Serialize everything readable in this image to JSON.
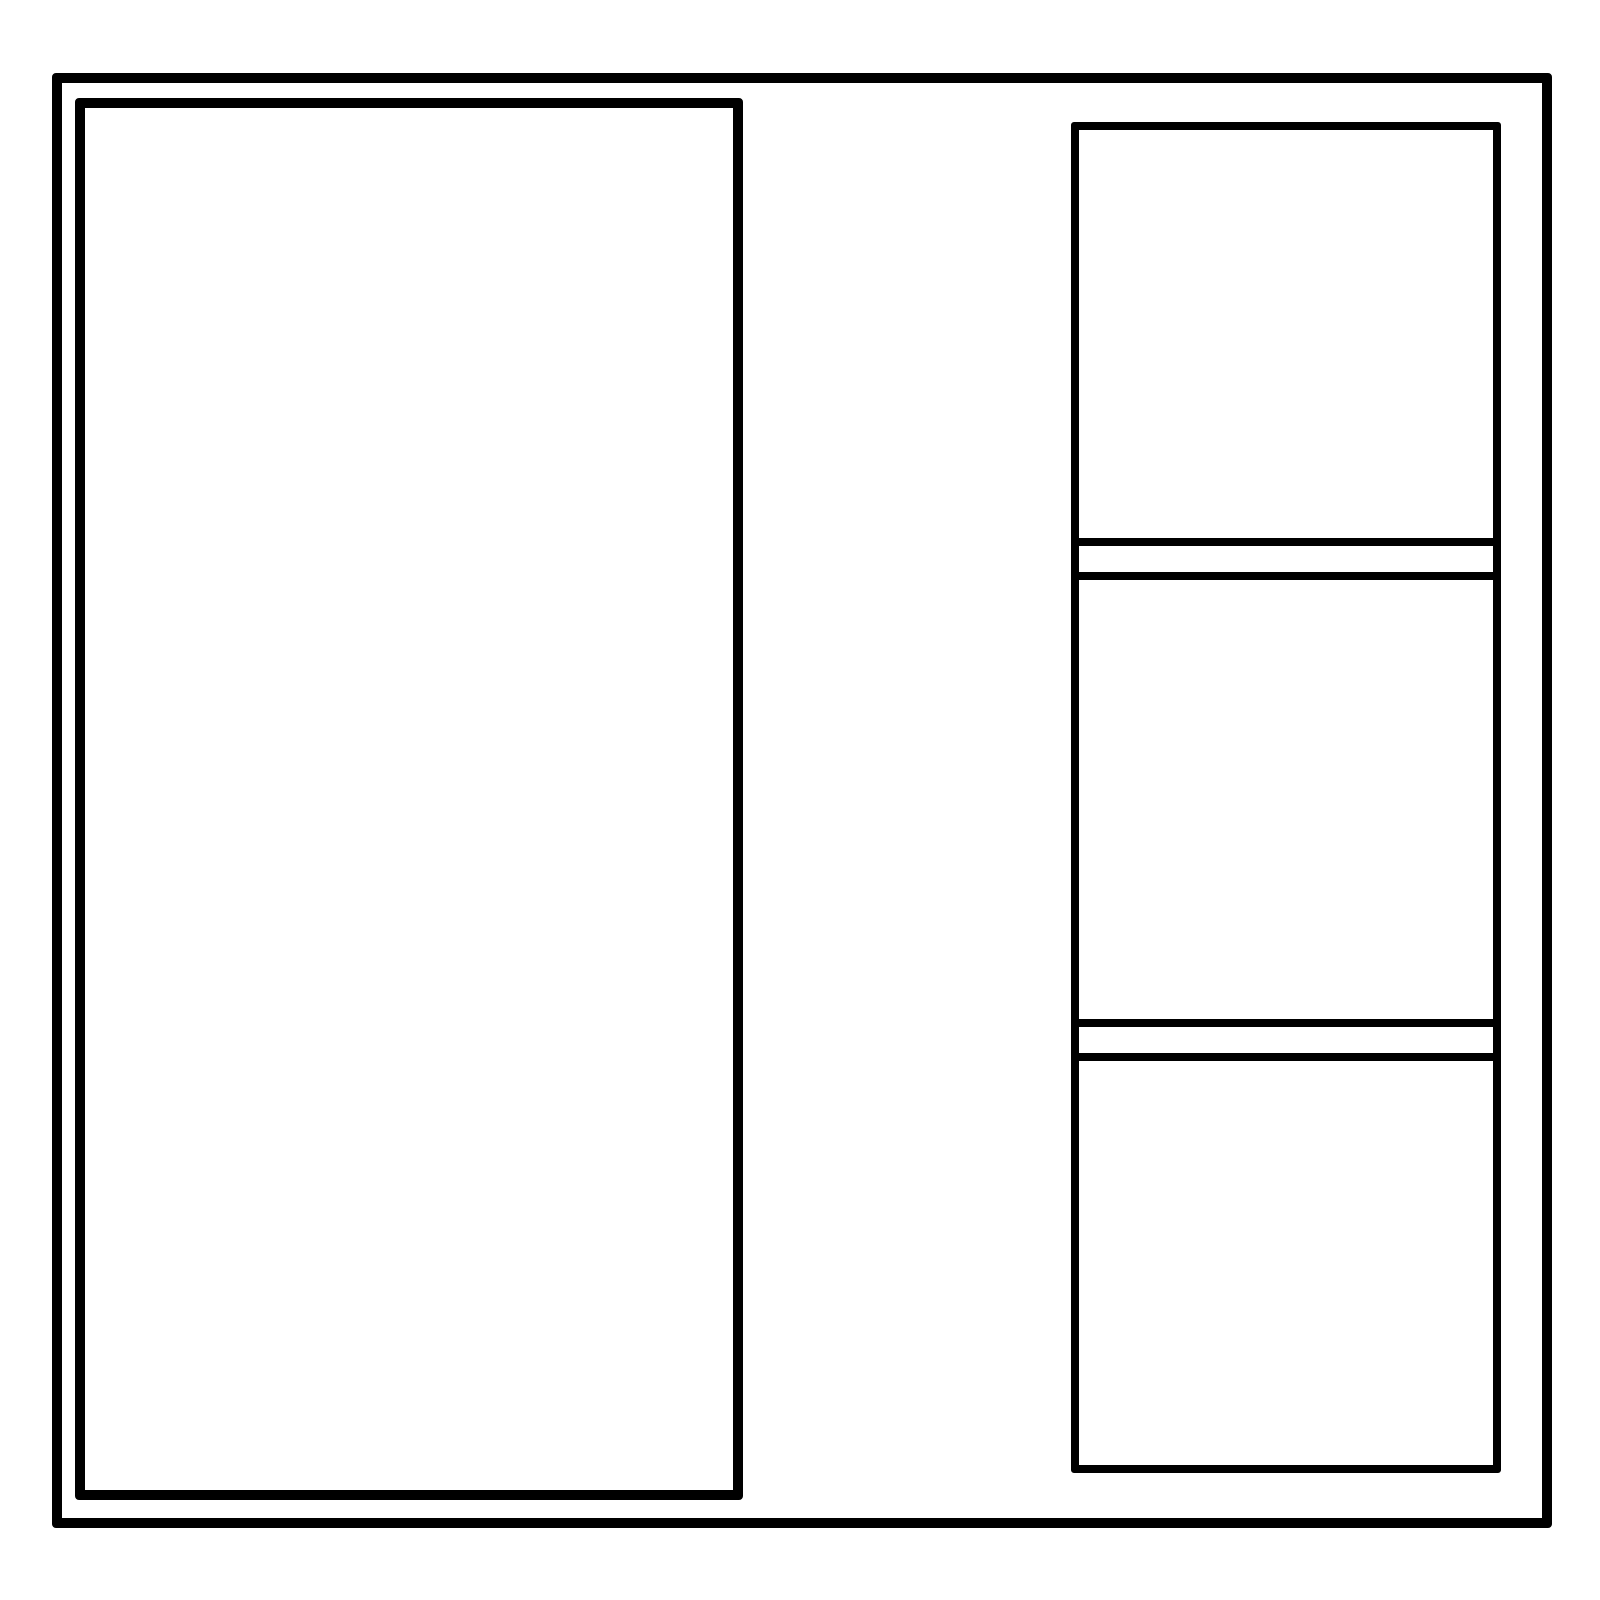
{
  "colors": {
    "background": "#ffffff",
    "stroke": "#000000"
  },
  "layout_wireframe": {
    "description_semantics": {
      "outer_frame": "window-frame",
      "left_panel": "large-content-panel",
      "right_column": "stacked-panel-column"
    },
    "right_column": {
      "section_count": 3,
      "separator_count": 2,
      "sections": [
        {
          "name": "right-section-top"
        },
        {
          "name": "right-section-middle"
        },
        {
          "name": "right-section-bottom"
        }
      ]
    },
    "text_content": []
  }
}
